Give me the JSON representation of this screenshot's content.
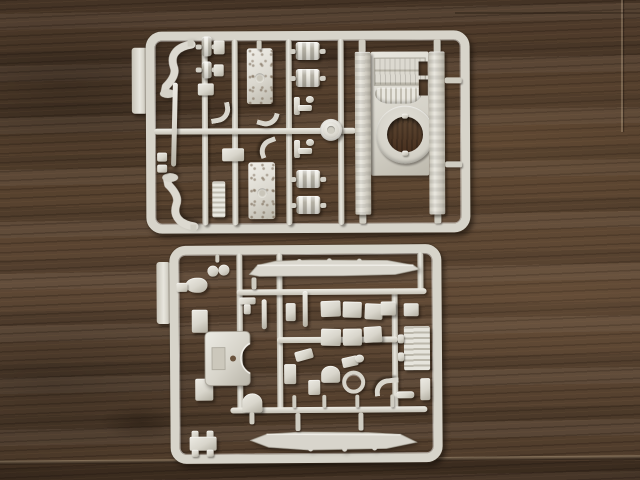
{
  "scene": {
    "title": "Two grey plastic model-kit sprues on a dark wooden table",
    "description": "Top-down photograph of two light-grey injection-moulded sprues from a small-scale tank model kit, lying one above the other on a dark brown wood-grain surface.",
    "colors": {
      "wood_base": "#55402d",
      "wood_dark": "#3b2c1f",
      "wood_light": "#6f5841",
      "plastic": "#d8d5cb",
      "plastic_highlight": "#edebe4",
      "plastic_shadow": "#b2aea1"
    },
    "objects": [
      {
        "id": "sprue-top",
        "label": "Upper sprue: tank upper hull with round turret-ring opening, four ribbed fuel drums, idler wheel, two curved fender brackets, two riveted plates, tow rod, ladder and small fittings"
      },
      {
        "id": "sprue-bottom",
        "label": "Lower sprue: two long track-and-fender runs, lower hull plate with circular cutout, six stowage boxes, engine grille panel, observation dome, searchlight ring, exhaust pipe and small fittings"
      }
    ],
    "parts_inventory": {
      "sprue_top": [
        "upper hull with turret ring opening",
        "4 ribbed fuel drums",
        "idler wheel",
        "2 curved fender brackets",
        "2 riveted detail plates",
        "tow rod",
        "ladder section",
        "assorted small fittings"
      ],
      "sprue_bottom": [
        "2 track-and-fender runs",
        "lower hull plate with round cutout",
        "6 stowage boxes",
        "engine grille panel",
        "observation dome",
        "searchlight ring",
        "exhaust pipe",
        "assorted small fittings"
      ]
    }
  }
}
